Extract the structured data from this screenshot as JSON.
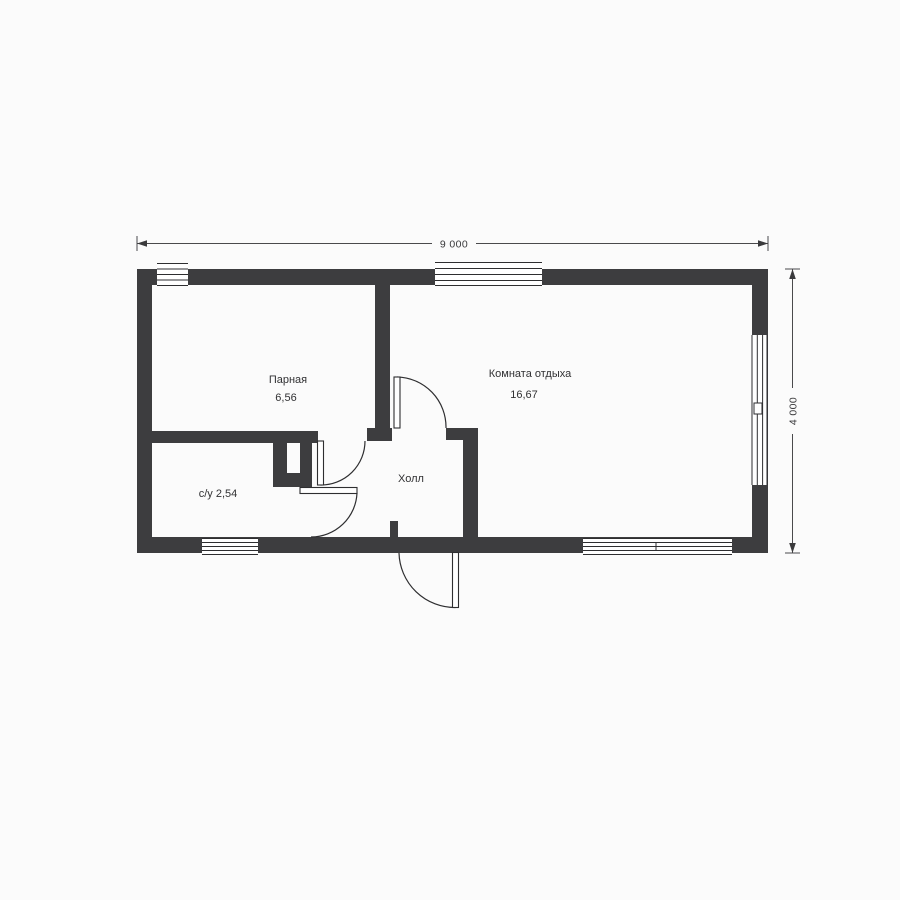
{
  "colors": {
    "wall": "#3d3d3f",
    "line": "#2e2e30",
    "text": "#313133",
    "background": "#fbfbfb",
    "window_fill": "#ffffff"
  },
  "dimensions": {
    "top": "9 000",
    "right": "4 000"
  },
  "rooms": [
    {
      "name": "Парная",
      "area": "6,56"
    },
    {
      "name": "Комната отдыха",
      "area": "16,67"
    },
    {
      "name": "с/у 2,54"
    },
    {
      "name": "Холл"
    }
  ]
}
